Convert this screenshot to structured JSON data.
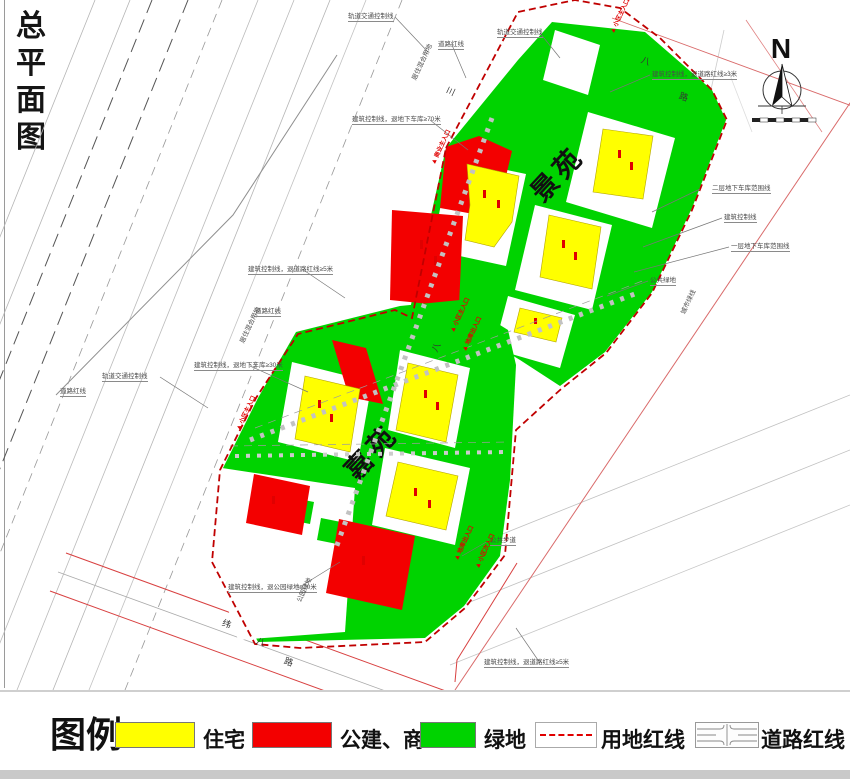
{
  "title": "总平面图",
  "north": {
    "label": "N"
  },
  "map": {
    "jingyuan_label": "景苑",
    "jiayuan_label": "嘉苑",
    "colors": {
      "residential": "#ffff00",
      "commercial": "#f30000",
      "green_space": "#00d300",
      "site_red_line": "#c00000",
      "road_red_line": "#d84040"
    },
    "annotations": [
      {
        "t": "轨道交通控制线",
        "x": 348,
        "y": 14,
        "r": 0
      },
      {
        "t": "轨道交通控制线",
        "x": 497,
        "y": 30,
        "r": 0
      },
      {
        "t": "道路红线",
        "x": 438,
        "y": 42,
        "r": 0
      },
      {
        "t": "建筑控制线，退地下车库≥70米",
        "x": 352,
        "y": 117,
        "r": 0
      },
      {
        "t": "居住混合用地",
        "x": 415,
        "y": 77,
        "r": -65
      },
      {
        "t": "居住混合用地",
        "x": 243,
        "y": 340,
        "r": -65
      },
      {
        "t": "道路红线",
        "x": 255,
        "y": 309,
        "r": 0
      },
      {
        "t": "建筑控制线，退道路红线≥5米",
        "x": 248,
        "y": 267,
        "r": 0
      },
      {
        "t": "建筑控制线，退地下车库≥30米",
        "x": 194,
        "y": 363,
        "r": 0
      },
      {
        "t": "轨道交通控制线",
        "x": 102,
        "y": 374,
        "r": 0
      },
      {
        "t": "道路红线",
        "x": 60,
        "y": 389,
        "r": 0
      },
      {
        "t": "二层地下车库范围线",
        "x": 712,
        "y": 186,
        "r": 0
      },
      {
        "t": "建筑控制线",
        "x": 724,
        "y": 215,
        "r": 0
      },
      {
        "t": "一层地下车库范围线",
        "x": 731,
        "y": 244,
        "r": 0
      },
      {
        "t": "公共绿地",
        "x": 650,
        "y": 278,
        "r": 0
      },
      {
        "t": "城市绿线",
        "x": 684,
        "y": 311,
        "r": -65
      },
      {
        "t": "建筑控制线，退道路红线≥3米",
        "x": 652,
        "y": 72,
        "r": 0
      },
      {
        "t": "公共步道",
        "x": 490,
        "y": 538,
        "r": 0
      },
      {
        "t": "建筑控制线，退公园绿地≥10米",
        "x": 228,
        "y": 585,
        "r": 0
      },
      {
        "t": "公园绿地",
        "x": 300,
        "y": 599,
        "r": -65
      },
      {
        "t": "建筑控制线，退道路红线≥5米",
        "x": 484,
        "y": 660,
        "r": 0
      }
    ],
    "entrances": [
      {
        "t": "小区主入口",
        "x": 238,
        "y": 427,
        "r": -65
      },
      {
        "t": "商业主入口",
        "x": 433,
        "y": 161,
        "r": -65
      },
      {
        "t": "小区主入口",
        "x": 612,
        "y": 30,
        "r": -65
      },
      {
        "t": "小区主入口",
        "x": 452,
        "y": 329,
        "r": -65
      },
      {
        "t": "地库出入口",
        "x": 464,
        "y": 348,
        "r": -65
      },
      {
        "t": "地库出入口",
        "x": 456,
        "y": 557,
        "r": -65
      },
      {
        "t": "小区次入口",
        "x": 477,
        "y": 565,
        "r": -65
      }
    ],
    "road_chars": [
      {
        "t": "三",
        "x": 447,
        "y": 87,
        "r": -65
      },
      {
        "t": "八",
        "x": 432,
        "y": 343,
        "r": -65
      },
      {
        "t": "八",
        "x": 641,
        "y": 57,
        "r": 20
      },
      {
        "t": "路",
        "x": 679,
        "y": 93,
        "r": 20
      },
      {
        "t": "纬",
        "x": 222,
        "y": 620,
        "r": 20
      },
      {
        "t": "八",
        "x": 256,
        "y": 638,
        "r": 20
      },
      {
        "t": "路",
        "x": 284,
        "y": 658,
        "r": 20
      }
    ]
  },
  "legend": {
    "heading": "图例:",
    "items": [
      {
        "label": "住宅",
        "type": "residential"
      },
      {
        "label": "公建、商业",
        "type": "commercial"
      },
      {
        "label": "绿地",
        "type": "green"
      },
      {
        "label": "用地红线",
        "type": "site-red-line"
      },
      {
        "label": "道路红线",
        "type": "road-red-line"
      }
    ]
  }
}
